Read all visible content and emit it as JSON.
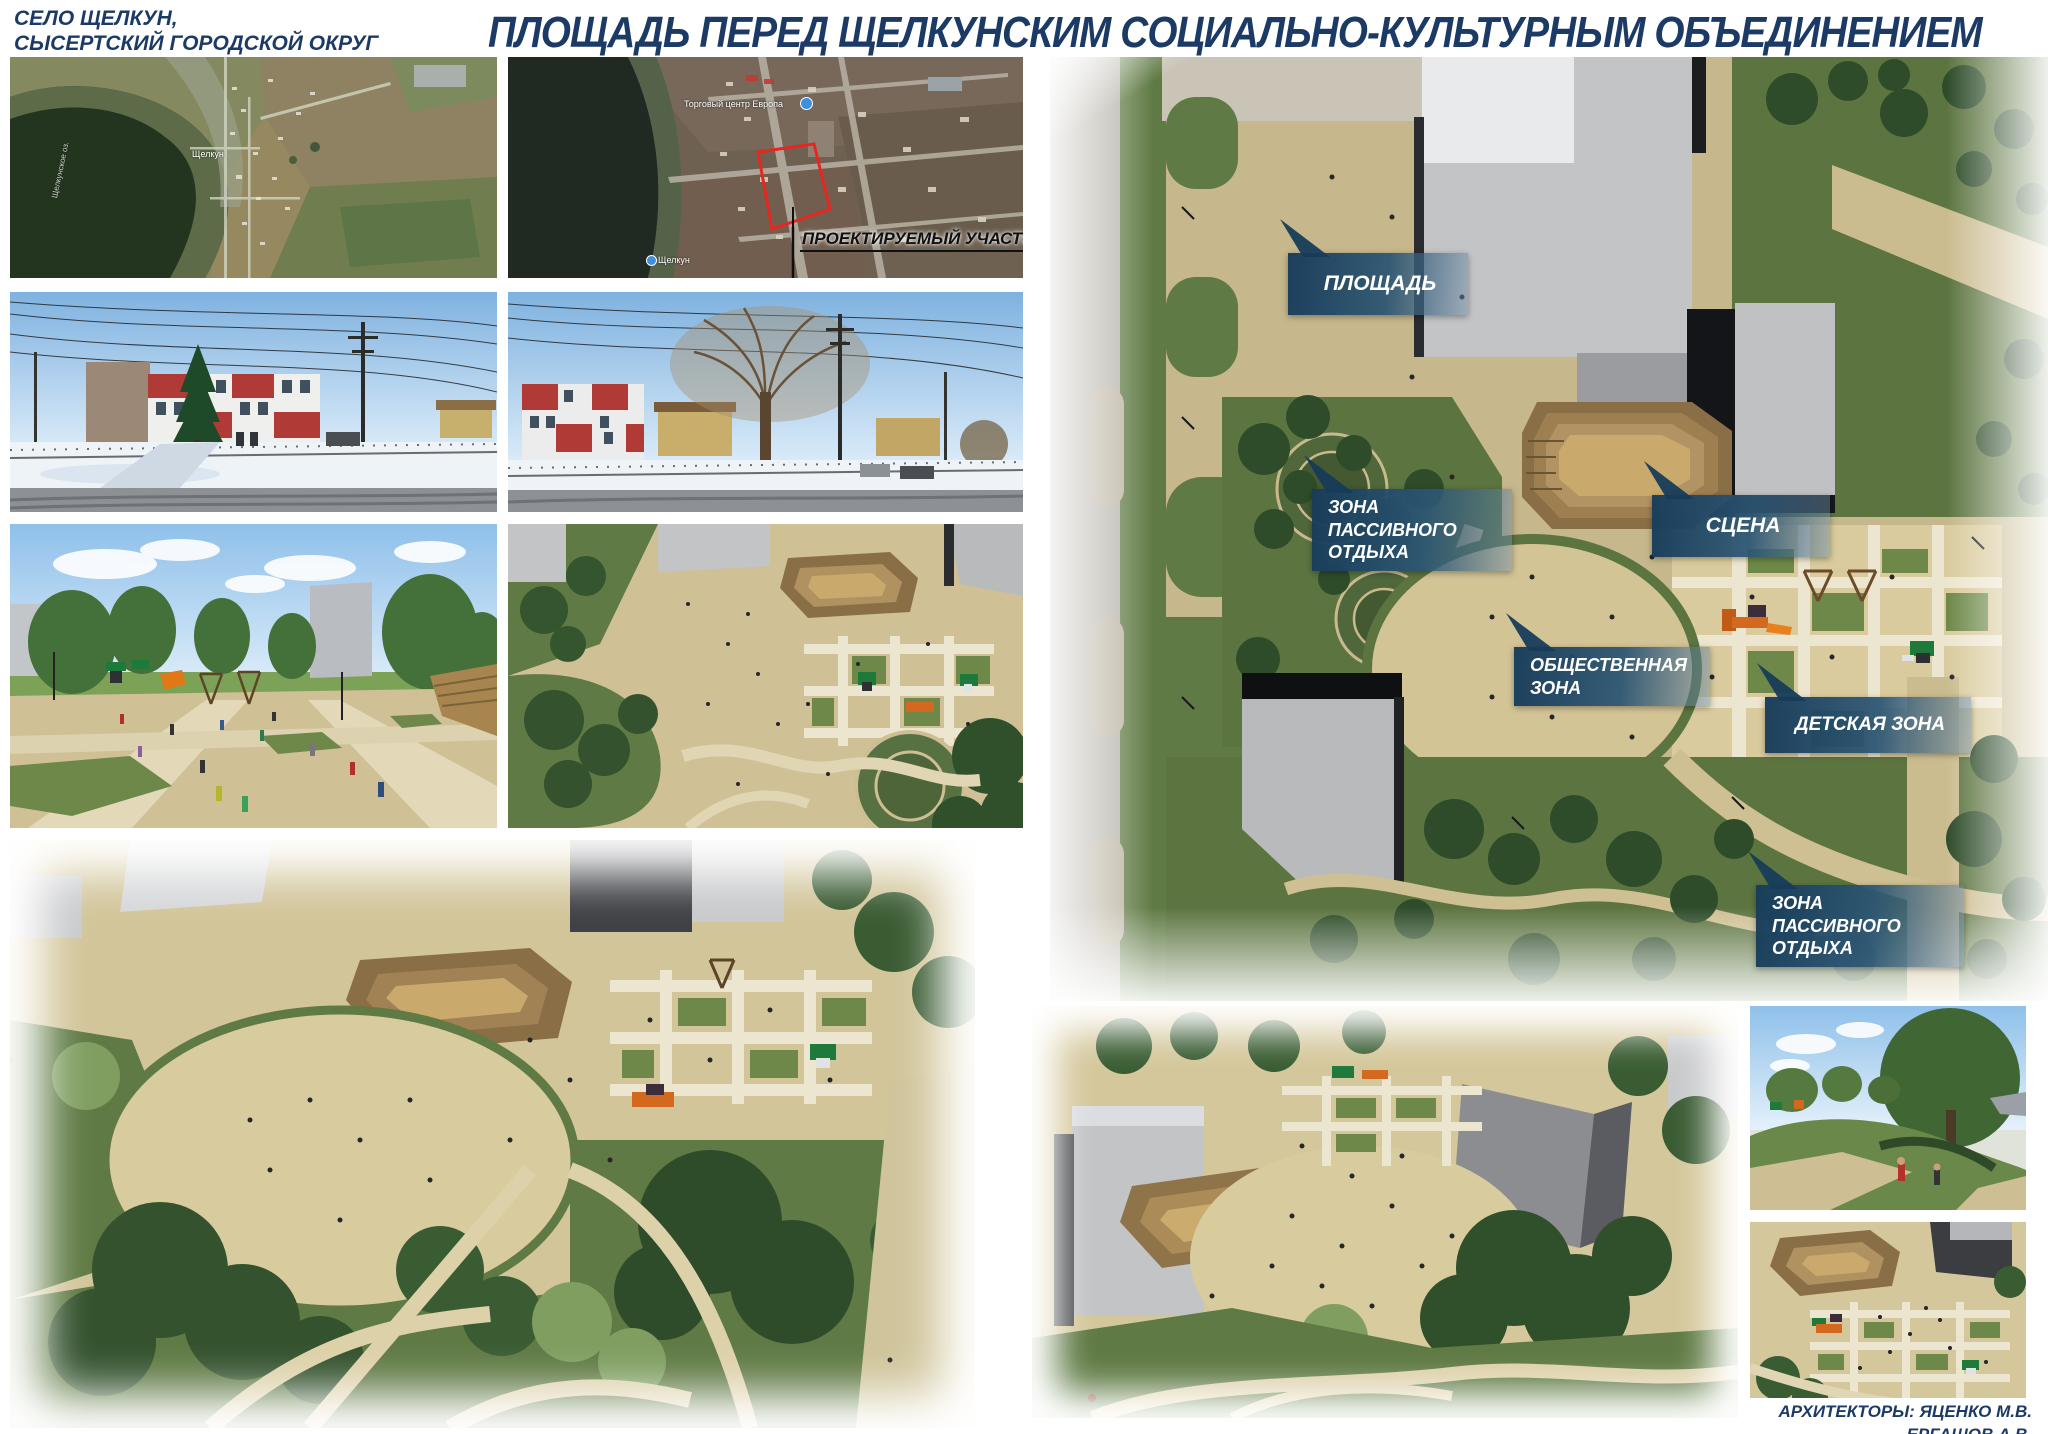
{
  "header": {
    "location_line1": "СЕЛО ЩЕЛКУН,",
    "location_line2": "СЫСЕРТСКИЙ ГОРОДСКОЙ ОКРУГ",
    "title": "ПЛОЩАДЬ ПЕРЕД ЩЕЛКУНСКИМ СОЦИАЛЬНО-КУЛЬТУРНЫМ ОБЪЕДИНЕНИЕМ"
  },
  "overview_map": {
    "village_label": "Щелкун",
    "lake_label": "Щелкунское оз."
  },
  "site_map": {
    "poi_label": "Торговый центр Европа",
    "village_label": "Щелкун",
    "project_site_label": "ПРОЕКТИРУЕМЫЙ УЧАСТОК",
    "site_outline_color": "#e8251f"
  },
  "master_plan": {
    "labels": [
      {
        "name": "ploshchad",
        "line1": "ПЛОЩАДЬ",
        "line2": ""
      },
      {
        "name": "zona-passivnogo-otdyha-upper",
        "line1": "ЗОНА ПАССИВНОГО",
        "line2": "ОТДЫХА"
      },
      {
        "name": "scena",
        "line1": "СЦЕНА",
        "line2": ""
      },
      {
        "name": "obshchestvennaya-zona",
        "line1": "ОБЩЕСТВЕННАЯ",
        "line2": "ЗОНА"
      },
      {
        "name": "detskaya-zona",
        "line1": "ДЕТСКАЯ ЗОНА",
        "line2": ""
      },
      {
        "name": "zona-passivnogo-otdyha-lower",
        "line1": "ЗОНА ПАССИВНОГО",
        "line2": "ОТДЫХА"
      }
    ]
  },
  "footer": {
    "credits_line1": "АРХИТЕКТОРЫ: ЯЦЕНКО М.В.",
    "credits_line2": "ЕРГАШОВ А.В."
  },
  "colors": {
    "title_navy": "#1c3a66",
    "label_banner_blue": "#1b4462",
    "site_outline_red": "#e8251f",
    "plan_ground_tan": "#c6b78c",
    "plan_lawn_green": "#5c7440"
  }
}
